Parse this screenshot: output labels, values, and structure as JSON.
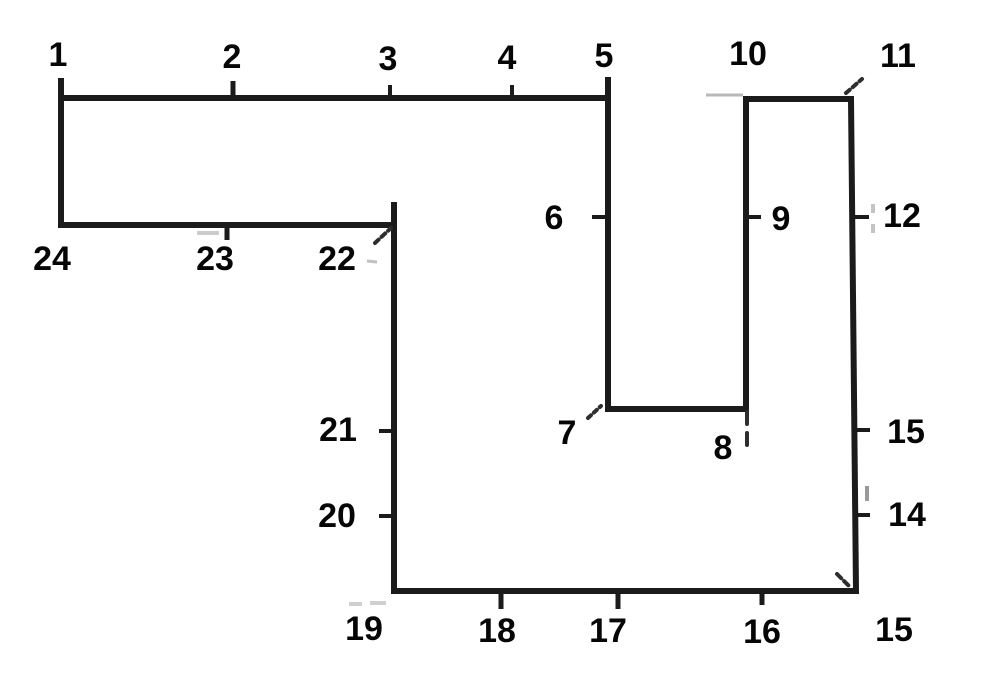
{
  "canvas": {
    "width": 1000,
    "height": 698,
    "background": "#ffffff"
  },
  "style": {
    "outline_color": "#1b1b1b",
    "outline_width": 6,
    "tick_color": "#1b1b1b",
    "corner_mark_color": "#2e2e2e",
    "label_color": "#060606",
    "label_font_size": 34
  },
  "outline": {
    "vertices": [
      [
        61,
        98
      ],
      [
        608,
        98
      ],
      [
        608,
        409
      ],
      [
        746,
        409
      ],
      [
        746,
        99
      ],
      [
        851,
        99
      ],
      [
        856,
        591
      ],
      [
        394,
        591
      ],
      [
        394,
        225
      ],
      [
        61,
        225
      ]
    ]
  },
  "point_labels": [
    {
      "text": "1",
      "x": 58,
      "y": 55
    },
    {
      "text": "2",
      "x": 232,
      "y": 57
    },
    {
      "text": "3",
      "x": 388,
      "y": 59
    },
    {
      "text": "4",
      "x": 507,
      "y": 58
    },
    {
      "text": "5",
      "x": 604,
      "y": 56
    },
    {
      "text": "10",
      "x": 748,
      "y": 54
    },
    {
      "text": "11",
      "x": 898,
      "y": 56
    },
    {
      "text": "6",
      "x": 554,
      "y": 218
    },
    {
      "text": "9",
      "x": 781,
      "y": 219
    },
    {
      "text": "12",
      "x": 902,
      "y": 216
    },
    {
      "text": "24",
      "x": 52,
      "y": 259
    },
    {
      "text": "23",
      "x": 215,
      "y": 259
    },
    {
      "text": "22",
      "x": 337,
      "y": 259
    },
    {
      "text": "21",
      "x": 338,
      "y": 430
    },
    {
      "text": "7",
      "x": 567,
      "y": 433
    },
    {
      "text": "8",
      "x": 723,
      "y": 448
    },
    {
      "text": "15",
      "x": 906,
      "y": 432
    },
    {
      "text": "20",
      "x": 337,
      "y": 516
    },
    {
      "text": "14",
      "x": 907,
      "y": 515
    },
    {
      "text": "19",
      "x": 364,
      "y": 629
    },
    {
      "text": "18",
      "x": 497,
      "y": 631
    },
    {
      "text": "17",
      "x": 608,
      "y": 631
    },
    {
      "text": "16",
      "x": 762,
      "y": 632
    },
    {
      "text": "15",
      "x": 894,
      "y": 630
    }
  ],
  "ticks": [
    {
      "x1": 61,
      "y1": 78,
      "x2": 61,
      "y2": 98,
      "w": 6
    },
    {
      "x1": 233,
      "y1": 81,
      "x2": 233,
      "y2": 98,
      "w": 5
    },
    {
      "x1": 390,
      "y1": 85,
      "x2": 390,
      "y2": 98,
      "w": 4
    },
    {
      "x1": 512,
      "y1": 85,
      "x2": 512,
      "y2": 98,
      "w": 4
    },
    {
      "x1": 608,
      "y1": 77,
      "x2": 608,
      "y2": 98,
      "w": 6
    },
    {
      "x1": 592,
      "y1": 217,
      "x2": 610,
      "y2": 217,
      "w": 4
    },
    {
      "x1": 746,
      "y1": 217,
      "x2": 761,
      "y2": 217,
      "w": 4
    },
    {
      "x1": 854,
      "y1": 217,
      "x2": 869,
      "y2": 217,
      "w": 4
    },
    {
      "x1": 855,
      "y1": 430,
      "x2": 870,
      "y2": 430,
      "w": 4
    },
    {
      "x1": 855,
      "y1": 515,
      "x2": 870,
      "y2": 515,
      "w": 4
    },
    {
      "x1": 762,
      "y1": 591,
      "x2": 762,
      "y2": 605,
      "w": 5
    },
    {
      "x1": 618,
      "y1": 592,
      "x2": 618,
      "y2": 609,
      "w": 5
    },
    {
      "x1": 501,
      "y1": 592,
      "x2": 501,
      "y2": 609,
      "w": 5
    },
    {
      "x1": 379,
      "y1": 516,
      "x2": 396,
      "y2": 516,
      "w": 4
    },
    {
      "x1": 379,
      "y1": 431,
      "x2": 396,
      "y2": 431,
      "w": 4
    },
    {
      "x1": 394,
      "y1": 202,
      "x2": 394,
      "y2": 228,
      "w": 6
    },
    {
      "x1": 227,
      "y1": 225,
      "x2": 227,
      "y2": 240,
      "w": 5
    }
  ],
  "corner_marks": [
    {
      "x1": 588,
      "y1": 418,
      "x2": 601,
      "y2": 406,
      "w": 4,
      "dash": "4 4"
    },
    {
      "x1": 846,
      "y1": 93,
      "x2": 862,
      "y2": 79,
      "w": 4,
      "dash": "5 4"
    },
    {
      "x1": 837,
      "y1": 574,
      "x2": 851,
      "y2": 588,
      "w": 4,
      "dash": "6 4"
    },
    {
      "x1": 375,
      "y1": 243,
      "x2": 391,
      "y2": 228,
      "w": 4,
      "dash": "5 4"
    },
    {
      "x1": 747,
      "y1": 412,
      "x2": 747,
      "y2": 446,
      "w": 4,
      "dash": "12 9"
    }
  ],
  "artifacts": [
    {
      "x1": 706,
      "y1": 95,
      "x2": 743,
      "y2": 95,
      "w": 3,
      "color": "#b8b8b8",
      "dash": ""
    },
    {
      "x1": 873,
      "y1": 204,
      "x2": 873,
      "y2": 238,
      "w": 4,
      "color": "#c4c4c4",
      "dash": "9 11"
    },
    {
      "x1": 867,
      "y1": 486,
      "x2": 867,
      "y2": 501,
      "w": 4,
      "color": "#9a9a9a",
      "dash": ""
    },
    {
      "x1": 197,
      "y1": 233,
      "x2": 219,
      "y2": 233,
      "w": 4,
      "color": "#cccccc",
      "dash": ""
    },
    {
      "x1": 349,
      "y1": 604,
      "x2": 362,
      "y2": 604,
      "w": 4,
      "color": "#cfcfcf",
      "dash": ""
    },
    {
      "x1": 370,
      "y1": 603,
      "x2": 386,
      "y2": 603,
      "w": 4,
      "color": "#cfcfcf",
      "dash": ""
    },
    {
      "x1": 367,
      "y1": 261,
      "x2": 377,
      "y2": 262,
      "w": 3,
      "color": "#c0c0c0",
      "dash": ""
    }
  ]
}
